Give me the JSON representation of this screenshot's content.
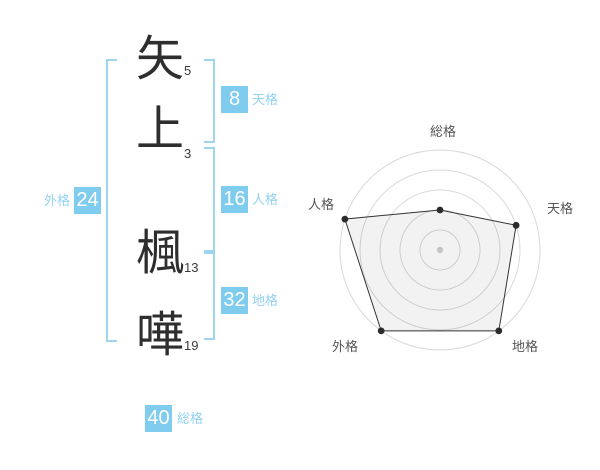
{
  "name": {
    "characters": [
      {
        "char": "矢",
        "strokes": "5"
      },
      {
        "char": "上",
        "strokes": "3"
      },
      {
        "char": "楓",
        "strokes": "13"
      },
      {
        "char": "嘩",
        "strokes": "19"
      }
    ]
  },
  "kaku": {
    "tenkaku": {
      "label": "天格",
      "value": "8"
    },
    "jinkaku": {
      "label": "人格",
      "value": "16"
    },
    "chikaku": {
      "label": "地格",
      "value": "32"
    },
    "gaikaku": {
      "label": "外格",
      "value": "24"
    },
    "soukaku": {
      "label": "総格",
      "value": "40"
    }
  },
  "colors": {
    "badge_blue": "#80ccef",
    "label_blue": "#92d2f2",
    "bracket_blue": "#9cd4f2",
    "text_dark": "#2e2e2e",
    "ring_gray": "#d9d9d9",
    "polygon_stroke": "#333333",
    "polygon_fill": "rgba(0,0,0,0.05)",
    "vertex_dot": "#2b2b2b",
    "center_dot": "#c5c5c5"
  },
  "chart_data": {
    "type": "radar",
    "categories": [
      "総格",
      "天格",
      "地格",
      "外格",
      "人格"
    ],
    "values": [
      2,
      4,
      5,
      5,
      5
    ],
    "axis_max": 5,
    "rings": 5,
    "start_angle_deg": 90,
    "direction": "clockwise",
    "grid": "concentric-circles",
    "legend": "none",
    "title": ""
  }
}
